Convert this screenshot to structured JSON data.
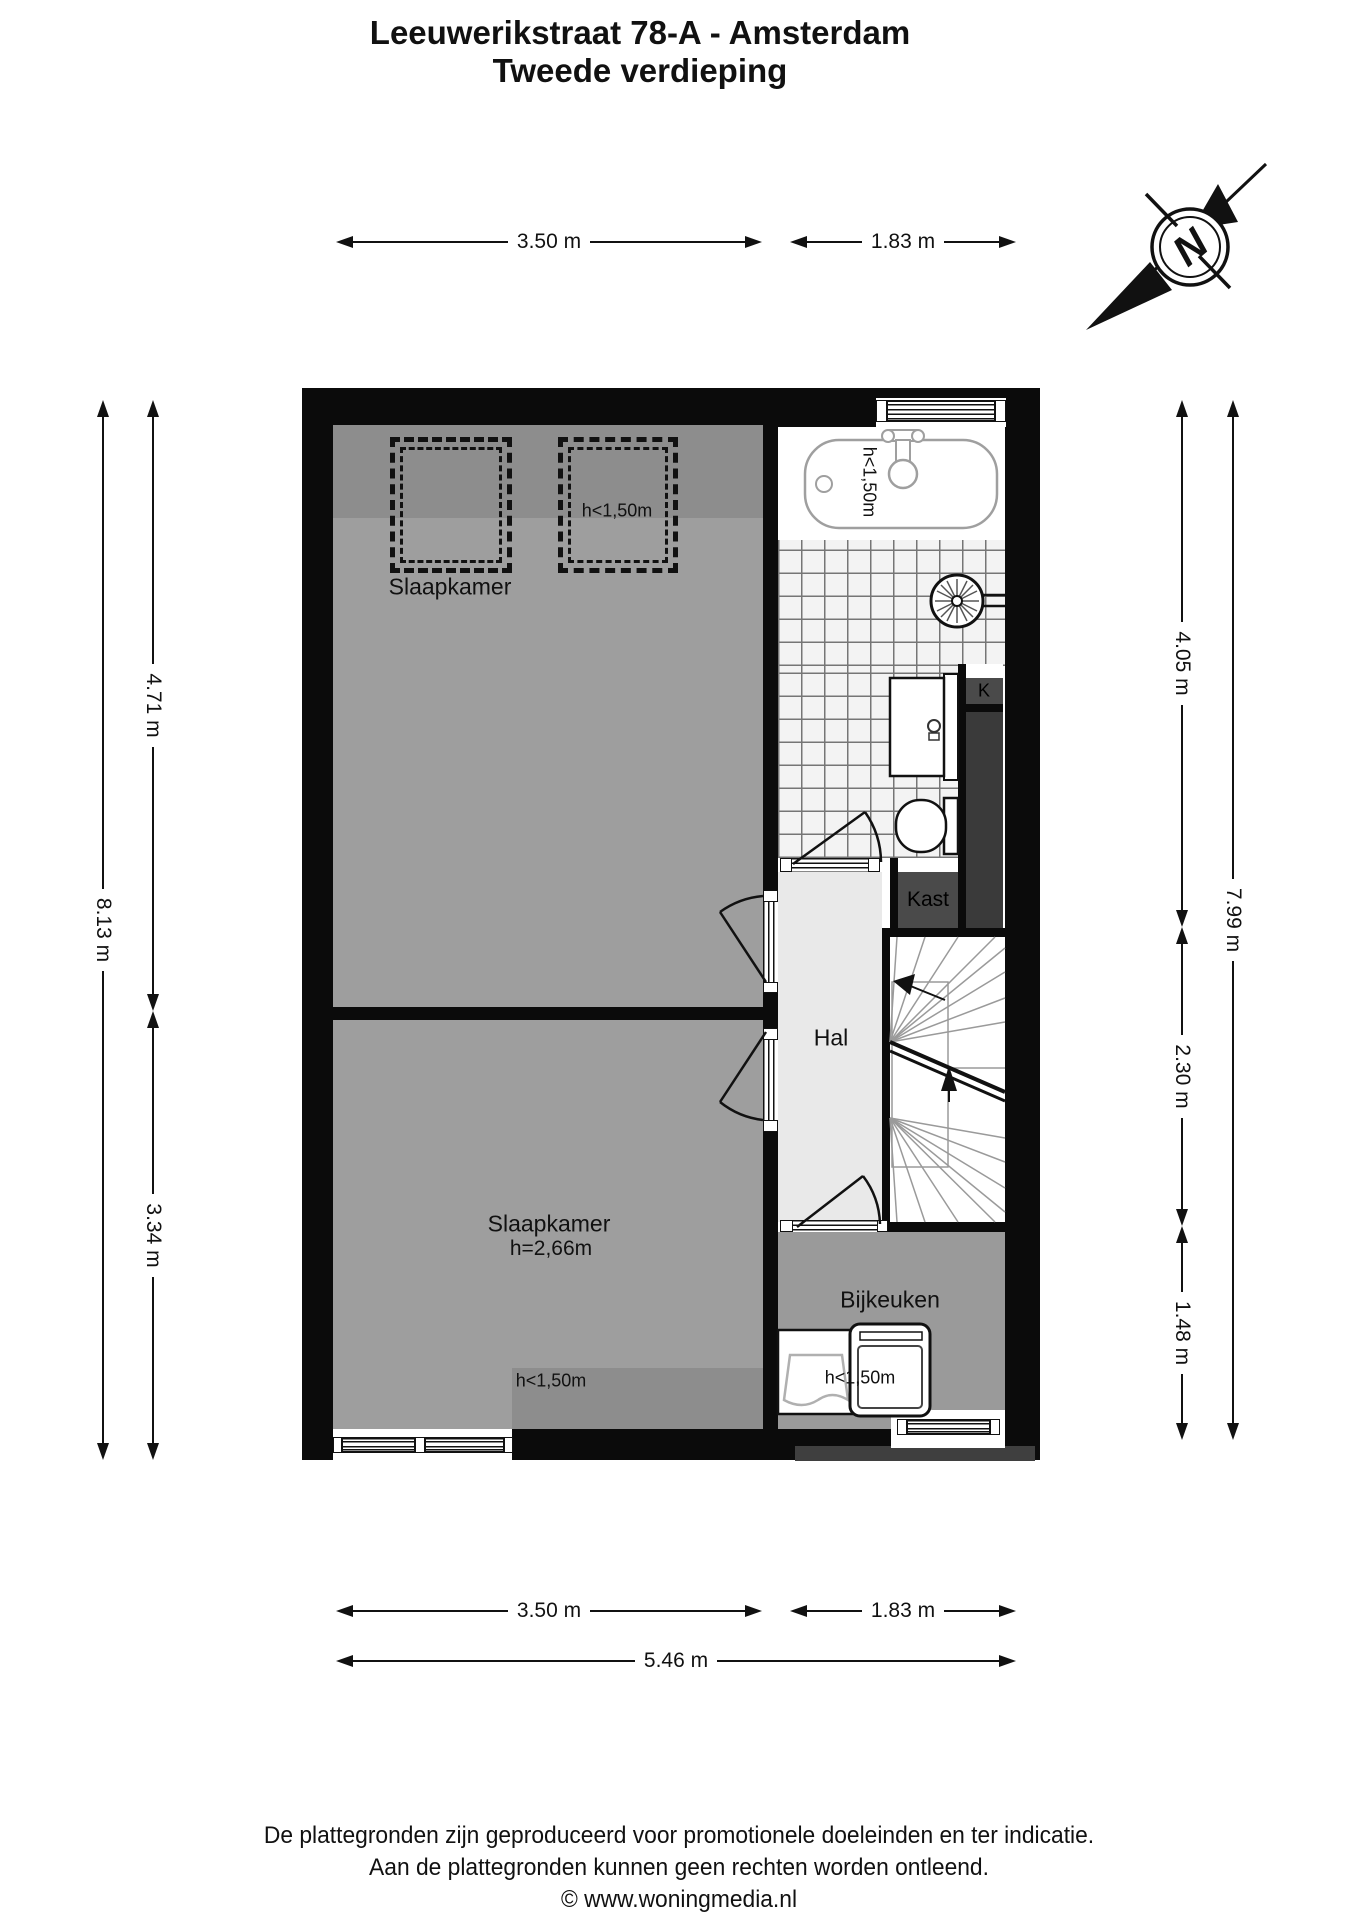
{
  "title": {
    "line1": "Leeuwerikstraat 78-A - Amsterdam",
    "line2": "Tweede verdieping"
  },
  "compass": {
    "north_label": "N"
  },
  "dimensions": {
    "top": {
      "width_left": "3.50 m",
      "width_right": "1.83 m"
    },
    "left": {
      "total": "8.13 m",
      "upper": "4.71 m",
      "lower": "3.34 m"
    },
    "right": {
      "upper": "4.05 m",
      "middle": "2.30 m",
      "lower": "1.48 m",
      "total": "7.99 m"
    },
    "bottom": {
      "width_left": "3.50 m",
      "width_right": "1.83 m",
      "total": "5.46 m"
    }
  },
  "rooms": {
    "bedroom_top": {
      "name": "Slaapkamer",
      "skylight_note": "h<1,50m"
    },
    "bedroom_bottom": {
      "name": "Slaapkamer",
      "ceiling_height": "h=2,66m",
      "low_note": "h<1,50m"
    },
    "hall": {
      "name": "Hal"
    },
    "closet": {
      "name": "Kast"
    },
    "closet_small": {
      "name": "K"
    },
    "utility": {
      "name": "Bijkeuken",
      "low_note": "h<1,50m"
    },
    "bathroom": {
      "bath_note": "h<1,50m"
    }
  },
  "footer": {
    "line1": "De plattegronden zijn geproduceerd voor promotionele doeleinden en ter indicatie.",
    "line2": "Aan de plattegronden kunnen geen rechten worden ontleend.",
    "line3": "© www.woningmedia.nl"
  },
  "colors": {
    "wall": "#0b0b0b",
    "floor": "#9e9e9e",
    "floor_low_ceiling": "#8d8d8d",
    "hall_floor": "#e9e9e9",
    "closet_dark": "#4a4a4a",
    "shaft_dark": "#3a3a3a",
    "tile_line": "#757575"
  }
}
